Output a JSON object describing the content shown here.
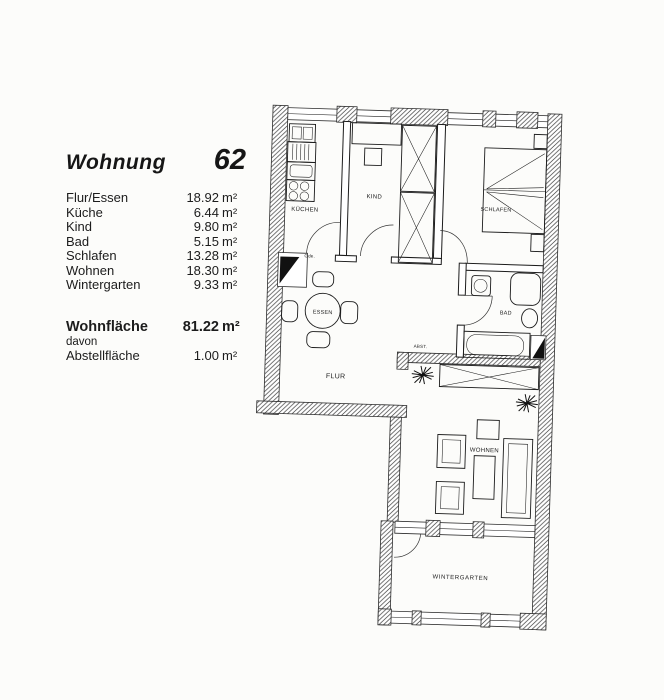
{
  "panel": {
    "title": "Wohnung",
    "number": "62",
    "unit": "m²",
    "rooms": [
      {
        "label": "Flur/Essen",
        "value": "18.92"
      },
      {
        "label": "Küche",
        "value": "6.44"
      },
      {
        "label": "Kind",
        "value": "9.80"
      },
      {
        "label": "Bad",
        "value": "5.15"
      },
      {
        "label": "Schlafen",
        "value": "13.28"
      },
      {
        "label": "Wohnen",
        "value": "18.30"
      },
      {
        "label": "Wintergarten",
        "value": "9.33"
      }
    ],
    "total": {
      "label": "Wohnfläche",
      "value": "81.22"
    },
    "davon": "davon",
    "storage": {
      "label": "Abstellfläche",
      "value": "1.00"
    }
  },
  "plan": {
    "labels": {
      "kueche": "KÜCHEN",
      "kind": "KIND",
      "schlafen": "SCHLAFEN",
      "bad": "BAD",
      "essen": "ESSEN",
      "flur": "FLUR",
      "abst": "ABST.",
      "wohnen": "WOHNEN",
      "wintergarten": "WINTERGARTEN",
      "garderobe": "Gde."
    },
    "colors": {
      "ink": "#1c1c1c",
      "paper": "#fcfcfa"
    }
  }
}
